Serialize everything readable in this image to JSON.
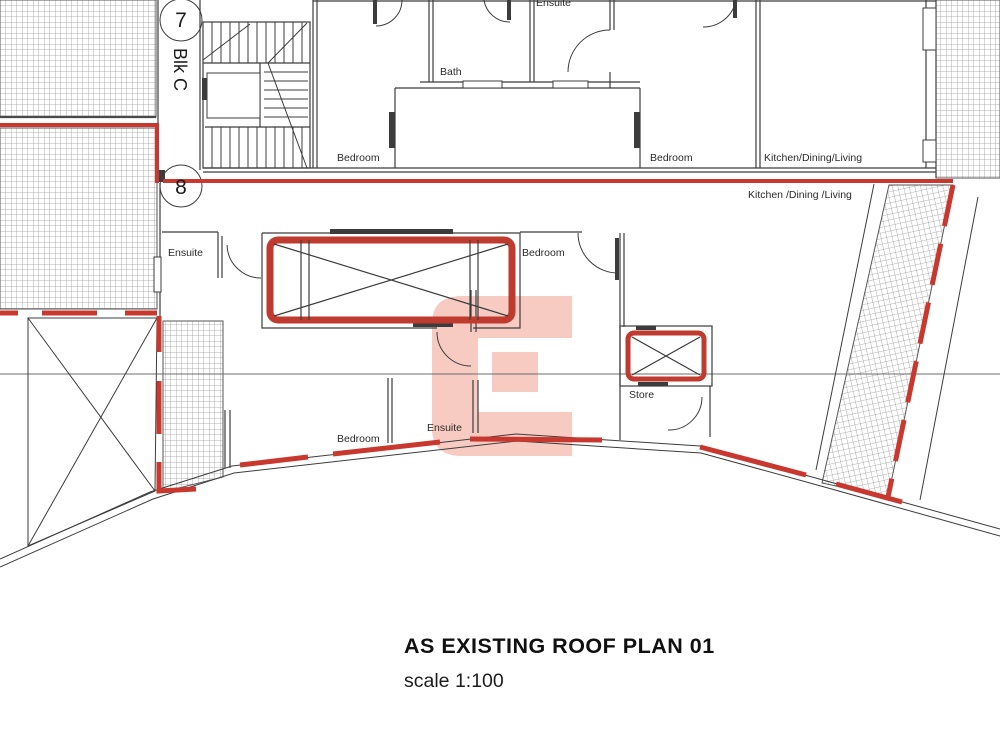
{
  "title": {
    "main": "AS EXISTING ROOF PLAN 01",
    "scale": "scale 1:100"
  },
  "grid": {
    "top": "7",
    "block": "Blk C",
    "bottom": "8"
  },
  "labels": {
    "bedroom_top_left": "Bedroom",
    "bath": "Bath",
    "ensuite_top": "Ensuite",
    "bedroom_top_right": "Bedroom",
    "kitchen_top": "Kitchen/Dining/Living",
    "kitchen_mid": "Kitchen /Dining /Living",
    "ensuite_mid": "Ensuite",
    "bedroom_mid": "Bedroom",
    "store": "Store",
    "bedroom_low": "Bedroom",
    "ensuite_low": "Ensuite"
  },
  "watermark_letter": "C",
  "colors": {
    "red_line": "#c9382e",
    "roof_red": "#bf3b2f",
    "watermark_pink": "#f7cbc2",
    "wall": "#3c3c3c",
    "hatch": "#9a9a9a"
  }
}
